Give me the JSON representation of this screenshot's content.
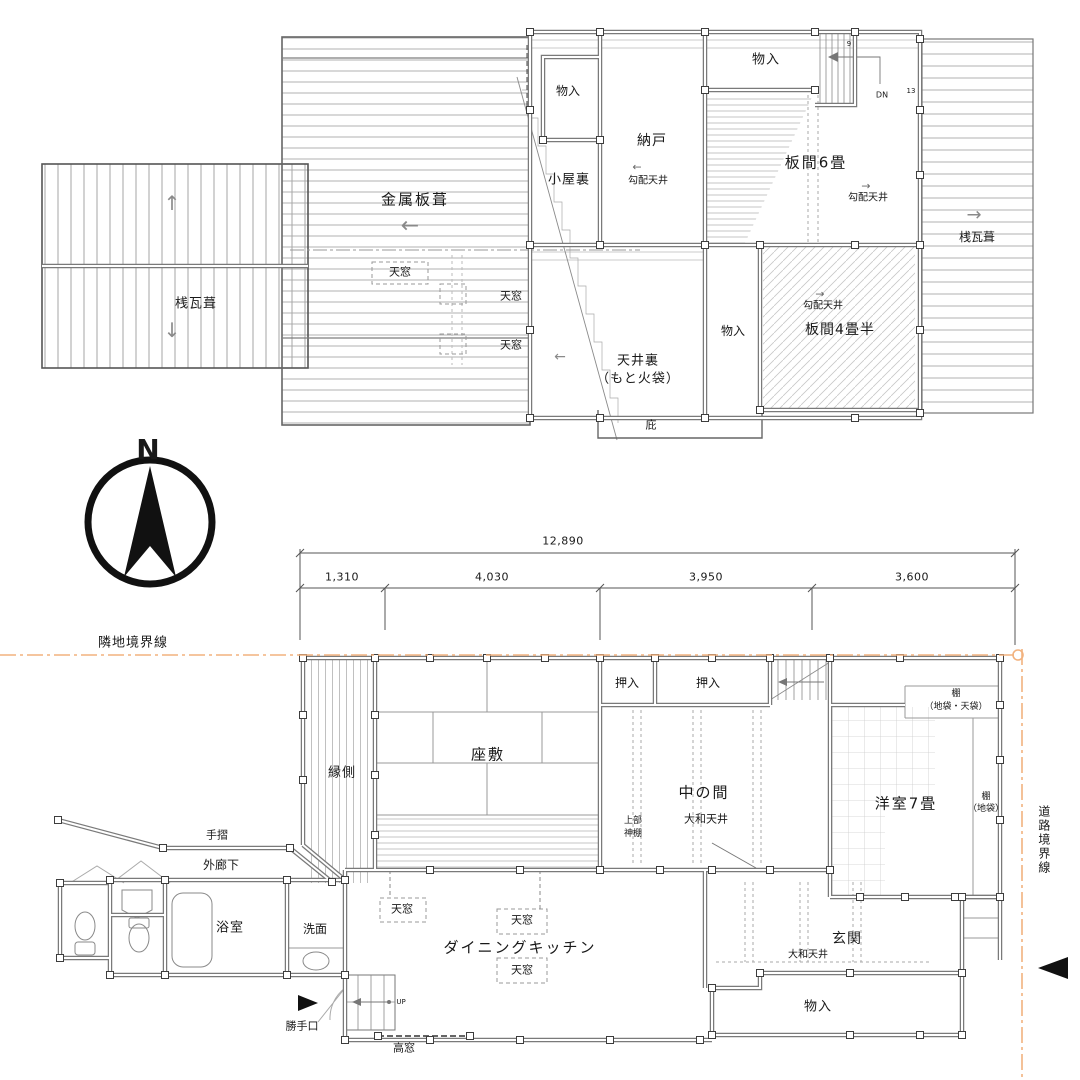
{
  "compass": {
    "north": "N"
  },
  "boundaries": {
    "adjacent": "隣地境界線",
    "road": "道路境界線"
  },
  "dimensions": {
    "total": "12,890",
    "seg1": "1,310",
    "seg2": "4,030",
    "seg3": "3,950",
    "seg4": "3,600"
  },
  "colors": {
    "boundary_line": "#f2b27e",
    "wall": "#7a7a7a",
    "hatch": "#b5b5b5",
    "text": "#191919"
  },
  "icons": {
    "arrow_left": "←",
    "arrow_right": "→",
    "arrow_up": "↑",
    "arrow_down": "↓"
  },
  "upper_plan": {
    "metal_roof": "金属板葺",
    "tile_roof_left": "桟瓦葺",
    "tile_roof_right": "桟瓦葺",
    "skylight1": "天窓",
    "skylight2": "天窓",
    "skylight3": "天窓",
    "closet_top_left": "物入",
    "attic": "小屋裏",
    "storeroom": "納戸",
    "sloped_ceiling_storeroom": "勾配天井",
    "closet_top": "物入",
    "board_room_6": "板間6畳",
    "sloped_ceiling_6": "勾配天井",
    "stairs_dn": "DN",
    "stair_num_top": "9",
    "stair_num_right": "13",
    "ceiling_space_line1": "天井裏",
    "ceiling_space_line2": "（もと火袋）",
    "closet_mid": "物入",
    "board_room_45": "板間4畳半",
    "sloped_ceiling_45": "勾配天井",
    "eave": "庇"
  },
  "lower_plan": {
    "veranda": "縁側",
    "zashiki": "座敷",
    "oshiire1": "押入",
    "oshiire2": "押入",
    "middle_room": "中の間",
    "yamato_ceiling_middle": "大和天井",
    "kamidana_line1": "上部",
    "kamidana_line2": "神棚",
    "western_room": "洋室7畳",
    "shelf_top_line1": "棚",
    "shelf_top_line2": "（地袋・天袋）",
    "shelf_right_line1": "棚",
    "shelf_right_line2": "（地袋）",
    "entrance": "玄関",
    "yamato_ceiling_entrance": "大和天井",
    "storage_bottom": "物入",
    "dining_kitchen": "ダイニングキッチン",
    "skylight1": "天窓",
    "skylight2": "天窓",
    "skylight3": "天窓",
    "high_window": "高窓",
    "handrail": "手摺",
    "outer_corridor": "外廊下",
    "bathroom": "浴室",
    "washroom": "洗面",
    "back_door": "勝手口",
    "stairs_up": "UP"
  }
}
